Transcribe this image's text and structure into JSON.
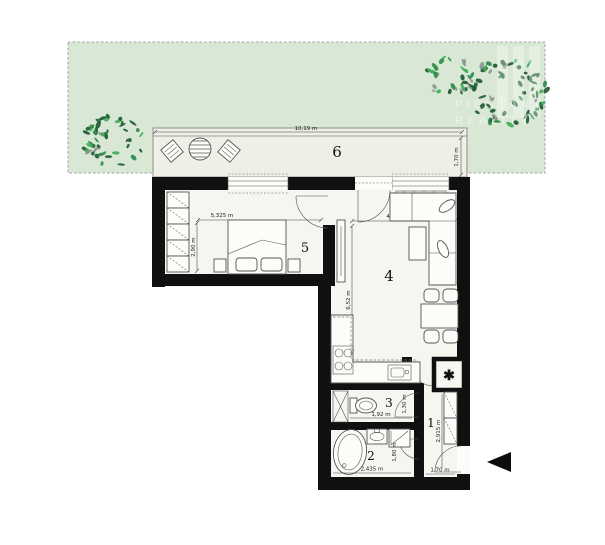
{
  "watermark": {
    "brand_line1": "PIEŠŤANY",
    "brand_line2": "REALITY"
  },
  "room_labels": {
    "terrace": "6",
    "bedroom": "5",
    "living": "4",
    "wc": "3",
    "bathroom": "2",
    "hall": "1"
  },
  "dimensions": {
    "terrace_width": "10,19 m",
    "terrace_depth": "1,70 m",
    "bedroom_width": "5,325 m",
    "bedroom_depth": "2,90 m",
    "living_width": "4,25 m",
    "living_depth": "6,52 m",
    "wc_width": "1,92 m",
    "wc_depth": "1,30 m",
    "bath_width": "2,435 m",
    "bath_depth": "1,80 m",
    "hall_depth": "2,915 m",
    "hall_width": "1,70 m"
  },
  "symbols": {
    "shaft": "✱"
  },
  "colors": {
    "garden": "#d9e8d5",
    "floor": "#f6f5ef",
    "terrace": "#efefe8",
    "wall": "#101010",
    "line": "#555555",
    "tree_dark": "#205a33",
    "tree_mid": "#2e8b4a",
    "tree_light": "#3fae57",
    "tree_gray": "#8e968f"
  }
}
